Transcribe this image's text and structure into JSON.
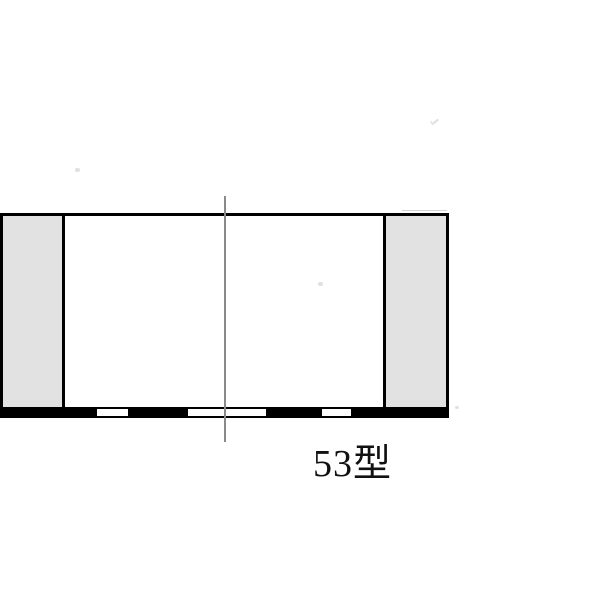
{
  "drawing": {
    "label": "53型",
    "colors": {
      "background": "#ffffff",
      "outline": "#000000",
      "panel_fill": "#e2e2e2",
      "base_bar": "#000000",
      "slot_fill": "#ffffff",
      "centerline": "#8a8a8a",
      "label_text": "#111111"
    }
  }
}
